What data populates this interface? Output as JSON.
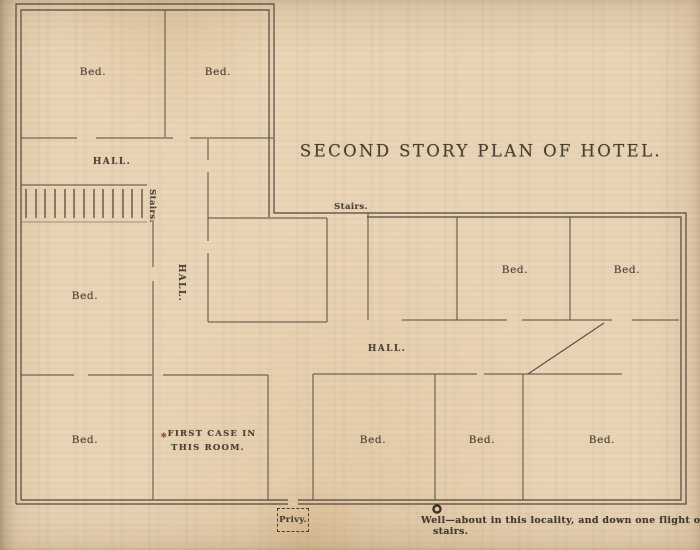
{
  "plan": {
    "title": "SECOND STORY PLAN OF HOTEL.",
    "labels": {
      "bed_top_left": "Bed.",
      "bed_top_mid": "Bed.",
      "hall_upper": "HALL.",
      "stairs_left": "Stairs.",
      "hall_vertical": "HALL.",
      "bed_mid_left": "Bed.",
      "bed_bottom_left": "Bed.",
      "first_case_line1": "FIRST CASE IN",
      "first_case_line2": "THIS ROOM.",
      "first_case_marker": "*",
      "stairs_right": "Stairs.",
      "bed_right_top_2": "Bed.",
      "bed_right_top_3": "Bed.",
      "hall_right": "HALL.",
      "bed_right_bottom_1": "Bed.",
      "bed_right_bottom_2": "Bed.",
      "bed_right_bottom_3": "Bed.",
      "privy": "Privy.",
      "well_note_line1": "Well—about in this locality, and down one flight of",
      "well_note_line2": "stairs."
    },
    "colors": {
      "paper": "#e9d4b5",
      "wall_line": "#53483a",
      "ink": "#4a4136",
      "first_case_marker": "#8a4030"
    }
  }
}
